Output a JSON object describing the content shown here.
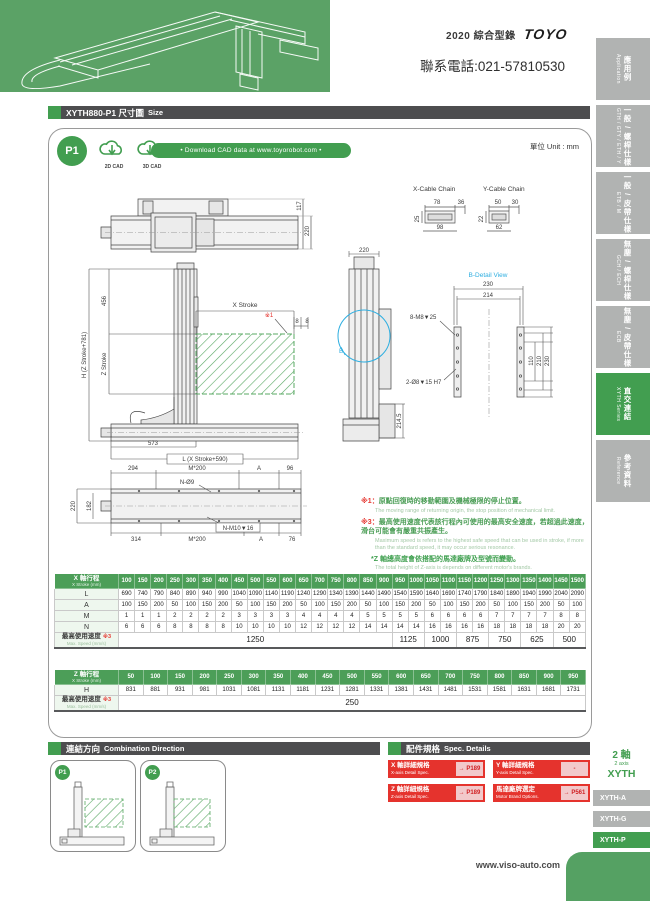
{
  "header": {
    "catalog": "2020 綜合型錄",
    "brand": "TOYO",
    "phone": "聯系電話:021-57810530"
  },
  "sidebar": {
    "items": [
      {
        "id": "application",
        "zh": "應用例",
        "en": "Application",
        "active": false
      },
      {
        "id": "gth",
        "zh": "一般 / 螺桿仕樣",
        "en": "GTH / GTY / ETH / Y",
        "active": false
      },
      {
        "id": "etb",
        "zh": "一般 / 皮帶仕樣",
        "en": "ETB / M",
        "active": false
      },
      {
        "id": "gch",
        "zh": "無塵 / 螺桿仕樣",
        "en": "GCH / ECH",
        "active": false
      },
      {
        "id": "ecb",
        "zh": "無塵 / 皮帶仕樣",
        "en": "ECB",
        "active": false
      },
      {
        "id": "xyth",
        "zh": "直交連結",
        "en": "XYTH Series",
        "active": true
      },
      {
        "id": "reference",
        "zh": "參考資料",
        "en": "Reference",
        "active": false
      }
    ]
  },
  "title_bar": {
    "model": "XYTH880-P1",
    "zh": "尺寸圖",
    "en": "Size"
  },
  "cad": {
    "badge": "P1",
    "cad2d": "2D CAD",
    "cad3d": "3D CAD",
    "download": "• Download CAD data at www.toyorobot.com •",
    "unit": "單位 Unit : mm"
  },
  "drawing": {
    "cable_chains": {
      "x": {
        "label": "X-Cable Chain",
        "top": "78",
        "right": "36",
        "left": "25",
        "bottom": "98"
      },
      "y": {
        "label": "Y-Cable Chain",
        "top": "50",
        "right": "30",
        "left": "22",
        "bottom": "62"
      }
    },
    "plan": {
      "d117": "117",
      "d220": "220"
    },
    "front": {
      "d456": "456",
      "h": "H (Z Stroke+781)",
      "z_stroke": "Z Stroke",
      "x_stroke": "X Stroke",
      "ref1": "※1",
      "d8a": "8",
      "d8b": "8",
      "d573": "573",
      "l": "L (X Stroke+590)"
    },
    "side": {
      "d220": "220",
      "d2145": "214.5",
      "b": "B"
    },
    "b_detail": {
      "title": "B-Detail View",
      "d230": "230",
      "d214": "214",
      "holes_top": "8-M8▼25",
      "holes_bottom": "2-Ø8▼15 H7",
      "d110": "110",
      "d210": "210",
      "d230v": "230"
    },
    "base": {
      "d294": "294",
      "m200_top": "M*200",
      "a_top": "A",
      "d96": "96",
      "n_o9": "N-Ø9",
      "d220": "220",
      "d182": "182",
      "d314": "314",
      "m200_bottom": "M*200",
      "n_m10": "N-M10▼16",
      "a_bottom": "A",
      "d76": "76"
    },
    "notes": {
      "n1_marker": "※1：",
      "n1_zh": "原點回復時的移動範圍及機械極限的停止位置。",
      "n1_en": "The moving range of returning origin, the stop position of mechanical limit.",
      "n3_marker": "※3：",
      "n3_zh": "最高使用速度代表該行程內可使用的最高安全速度，若超過此速度，滑台可能會有嚴重共振產生。",
      "n3_en": "Maximum speed is refers to the highest safe speed that can be used in stroke, if more than the standard speed, it may occur serious resonance.",
      "z_zh": "*Z 軸總高度會依搭配的馬達廠牌及型號而變動。",
      "z_en": "The total height of Z-axis is depends on different motor's brands."
    }
  },
  "x_table": {
    "label_zh": "X 軸行程",
    "label_en": "X Stroke (mm)",
    "strokes": [
      100,
      150,
      200,
      250,
      300,
      350,
      400,
      450,
      500,
      550,
      600,
      650,
      700,
      750,
      800,
      850,
      900,
      950,
      1000,
      1050,
      1100,
      1150,
      1200,
      1250,
      1300,
      1350,
      1400,
      1450,
      1500
    ],
    "rows": [
      {
        "label": "L",
        "values": [
          690,
          740,
          790,
          840,
          890,
          940,
          990,
          1040,
          1090,
          1140,
          1190,
          1240,
          1290,
          1340,
          1390,
          1440,
          1490,
          1540,
          1590,
          1640,
          1690,
          1740,
          1790,
          1840,
          1890,
          1940,
          1990,
          2040,
          2090
        ]
      },
      {
        "label": "A",
        "values": [
          100,
          150,
          200,
          50,
          100,
          150,
          200,
          50,
          100,
          150,
          200,
          50,
          100,
          150,
          200,
          50,
          100,
          150,
          200,
          50,
          100,
          150,
          200,
          50,
          100,
          150,
          200,
          50,
          100
        ]
      },
      {
        "label": "M",
        "values": [
          1,
          1,
          1,
          2,
          2,
          2,
          2,
          3,
          3,
          3,
          3,
          4,
          4,
          4,
          4,
          5,
          5,
          5,
          5,
          6,
          6,
          6,
          6,
          7,
          7,
          7,
          7,
          8,
          8
        ]
      },
      {
        "label": "N",
        "values": [
          6,
          6,
          6,
          8,
          8,
          8,
          8,
          10,
          10,
          10,
          10,
          12,
          12,
          12,
          12,
          14,
          14,
          14,
          14,
          16,
          16,
          16,
          16,
          18,
          18,
          18,
          18,
          20,
          20
        ]
      }
    ],
    "speed": {
      "label_zh": "最高使用速度",
      "ref": "※3",
      "label_en": "Max. Speed (mm/s)",
      "groups": [
        {
          "value": 1250,
          "span": 17
        },
        {
          "value": 1125,
          "span": 2
        },
        {
          "value": 1000,
          "span": 2
        },
        {
          "value": 875,
          "span": 2
        },
        {
          "value": 750,
          "span": 2
        },
        {
          "value": 625,
          "span": 2
        },
        {
          "value": 500,
          "span": 2
        }
      ]
    }
  },
  "z_table": {
    "label_zh": "Z 軸行程",
    "label_en": "X Stroke (mm)",
    "strokes": [
      50,
      100,
      150,
      200,
      250,
      300,
      350,
      400,
      450,
      500,
      550,
      600,
      650,
      700,
      750,
      800,
      850,
      900,
      950
    ],
    "rows": [
      {
        "label": "H",
        "values": [
          831,
          881,
          931,
          981,
          1031,
          1081,
          1131,
          1181,
          1231,
          1281,
          1331,
          1381,
          1431,
          1481,
          1531,
          1581,
          1631,
          1681,
          1731
        ]
      }
    ],
    "speed": {
      "label_zh": "最高使用速度",
      "ref": "※3",
      "label_en": "Max. Speed (mm/s)",
      "groups": [
        {
          "value": 250,
          "span": 19
        }
      ]
    }
  },
  "combination": {
    "zh": "連結方向",
    "en": "Combination Direction",
    "cards": [
      {
        "label": "P1"
      },
      {
        "label": "P2"
      }
    ]
  },
  "spec": {
    "zh": "配件規格",
    "en": "Spec. Details",
    "buttons": [
      {
        "zh": "X 軸詳細規格",
        "en": "X-axis Detail Spec.",
        "link": "→ P189"
      },
      {
        "zh": "Y 軸詳細規格",
        "en": "Y-axis Detail Spec.",
        "link": "-"
      },
      {
        "zh": "Z 軸詳細規格",
        "en": "Z-axis Detail Spec.",
        "link": "→ P189"
      },
      {
        "zh": "馬達廠牌選定",
        "en": "Motor Brand Options.",
        "link": "→ P561"
      }
    ]
  },
  "footer": {
    "website": "www.viso-auto.com",
    "axis_zh": "2 軸",
    "axis_en": "2 axis",
    "series": "XYTH",
    "tabs": [
      {
        "label": "XYTH-A",
        "active": false
      },
      {
        "label": "XYTH-G",
        "active": false
      },
      {
        "label": "XYTH-P",
        "active": true
      },
      {
        "label": "XYTH-F",
        "active": false
      }
    ]
  }
}
